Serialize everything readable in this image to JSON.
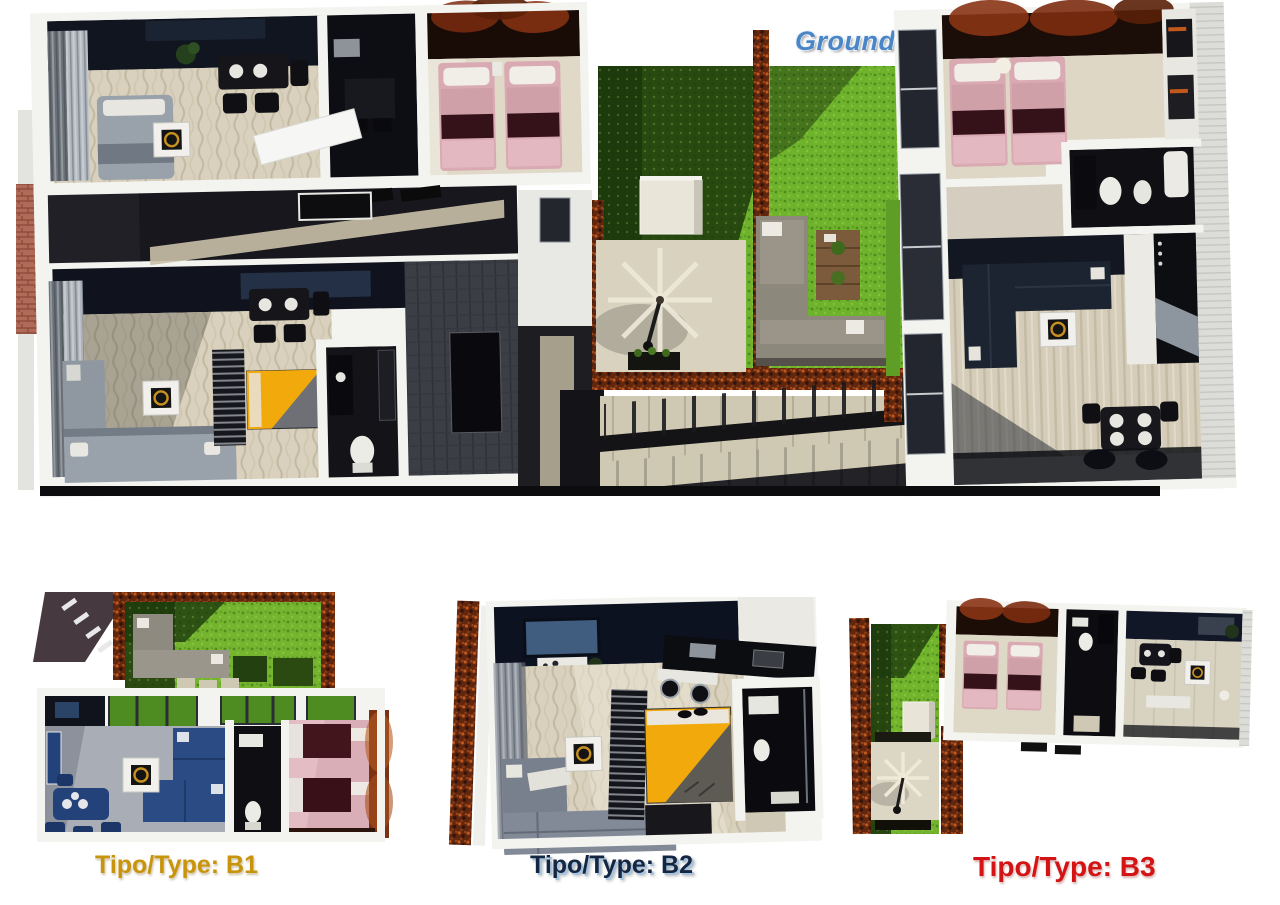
{
  "header": {
    "title_left": "Planta Baja",
    "title_right": "Ground Floor"
  },
  "units": [
    {
      "id": "b1",
      "label": "Tipo/Type: B1"
    },
    {
      "id": "b2",
      "label": "Tipo/Type: B2"
    },
    {
      "id": "b3",
      "label": "Tipo/Type: B3"
    }
  ],
  "palette": {
    "title_blue": "#4a86c6",
    "b1_gold": "#c8940c",
    "b2_navy": "#152642",
    "b3_red": "#d41414",
    "grass_bright": "#6fb32c",
    "grass_shadow": "#23430f",
    "hedge_brown": "#60260e",
    "floor_beige": "#d9d1bd",
    "wall_white": "#f3f3f0",
    "bed_pink": "#d9aab2",
    "bed_maroon": "#35121a",
    "bed_yellow": "#f2a90c",
    "sofa_gray": "#8f97a1",
    "sofa_navy": "#1c2431",
    "sofa_blue": "#2a4b84",
    "gold_accent": "#c89020"
  }
}
